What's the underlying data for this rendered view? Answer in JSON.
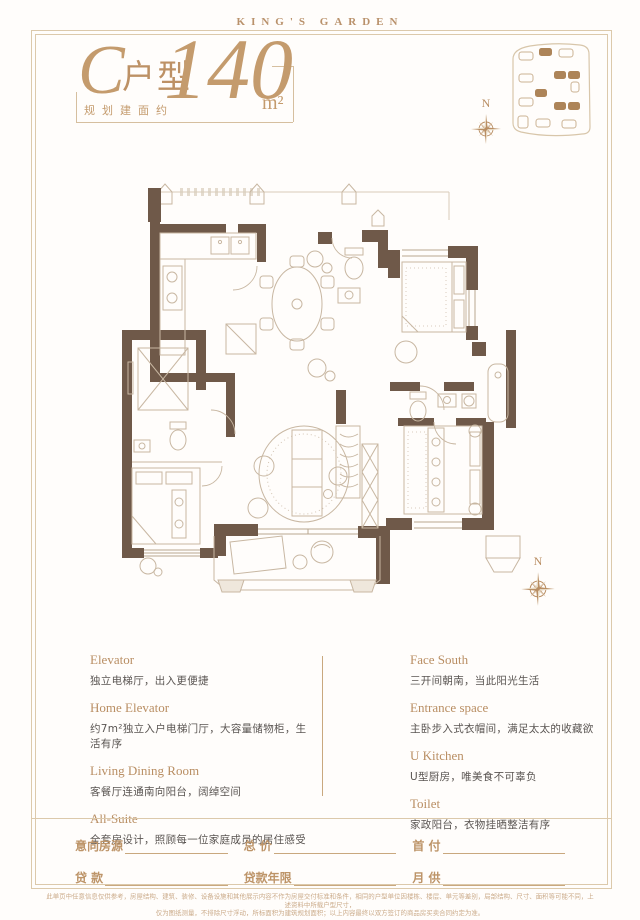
{
  "header": {
    "brand": "KING'S GARDEN"
  },
  "title": {
    "type_letter": "C",
    "type_suffix": "户型",
    "area_label": "规划建面约",
    "area_value": "140",
    "area_unit": "m²"
  },
  "compass": {
    "north_label": "N"
  },
  "colors": {
    "accent_gold": "#b98e63",
    "frame_line": "#dcc9ab",
    "wall_brown": "#6f5949",
    "plan_line": "#c8b7a2",
    "body_gray": "#5a5552"
  },
  "features": {
    "left": [
      {
        "en": "Elevator",
        "cn": "独立电梯厅，出入更便捷"
      },
      {
        "en": "Home Elevator",
        "cn": "约7m²独立入户电梯门厅，大容量储物柜，生活有序"
      },
      {
        "en": "Living Dining Room",
        "cn": "客餐厅连通南向阳台，阔绰空间"
      },
      {
        "en": "All-Suite",
        "cn": "全套房设计，照顾每一位家庭成员的居住感受"
      }
    ],
    "right": [
      {
        "en": "Face South",
        "cn": "三开间朝南，当此阳光生活"
      },
      {
        "en": "Entrance space",
        "cn": "主卧步入式衣帽间，满足太太的收藏欲"
      },
      {
        "en": "U Kitchen",
        "cn": "U型厨房，唯美食不可辜负"
      },
      {
        "en": "Toilet",
        "cn": "家政阳台，衣物挂晒整洁有序"
      }
    ]
  },
  "form": {
    "rows": [
      [
        {
          "label": "意向房源"
        },
        {
          "label": "总 价"
        },
        {
          "label": "首 付"
        }
      ],
      [
        {
          "label": "贷 款"
        },
        {
          "label": "贷款年限"
        },
        {
          "label": "月 供"
        }
      ]
    ]
  },
  "disclaimer": {
    "line1": "此单页中任意信息仅供参考，房屋结构、建筑、装修、设备设施和其他展示内容不作为房屋交付标准和条件，相同的户型单位因楼栋、楼层、单元等差别，局部结构、尺寸、面积等可能不同，上述资料中所载户型尺寸，",
    "line2": "仅为图纸测量，不排除尺寸浮动，所标面积为建筑规划面积；以上内容最终以双方签订的商品房买卖合同约定为准。"
  }
}
